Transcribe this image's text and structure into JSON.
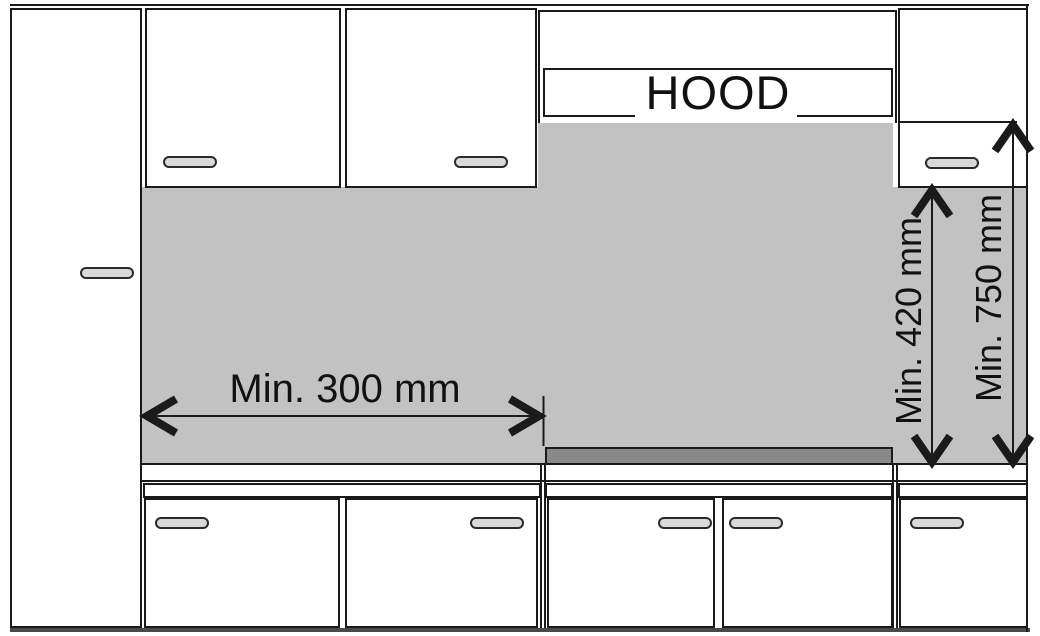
{
  "diagram": {
    "type": "kitchen-hood-installation-clearance",
    "hood_label": "HOOD",
    "dimensions": {
      "horizontal_min": "Min. 300 mm",
      "vertical_to_cabinet_min": "Min. 420 mm",
      "vertical_to_hood_min": "Min. 750 mm"
    },
    "colors": {
      "wall": "#c2c2c2",
      "hob": "#8a8a8a",
      "outline": "#1a1a1a",
      "handle": "#d9d9d9",
      "floor": "#4a4a4a",
      "background": "#ffffff"
    }
  }
}
